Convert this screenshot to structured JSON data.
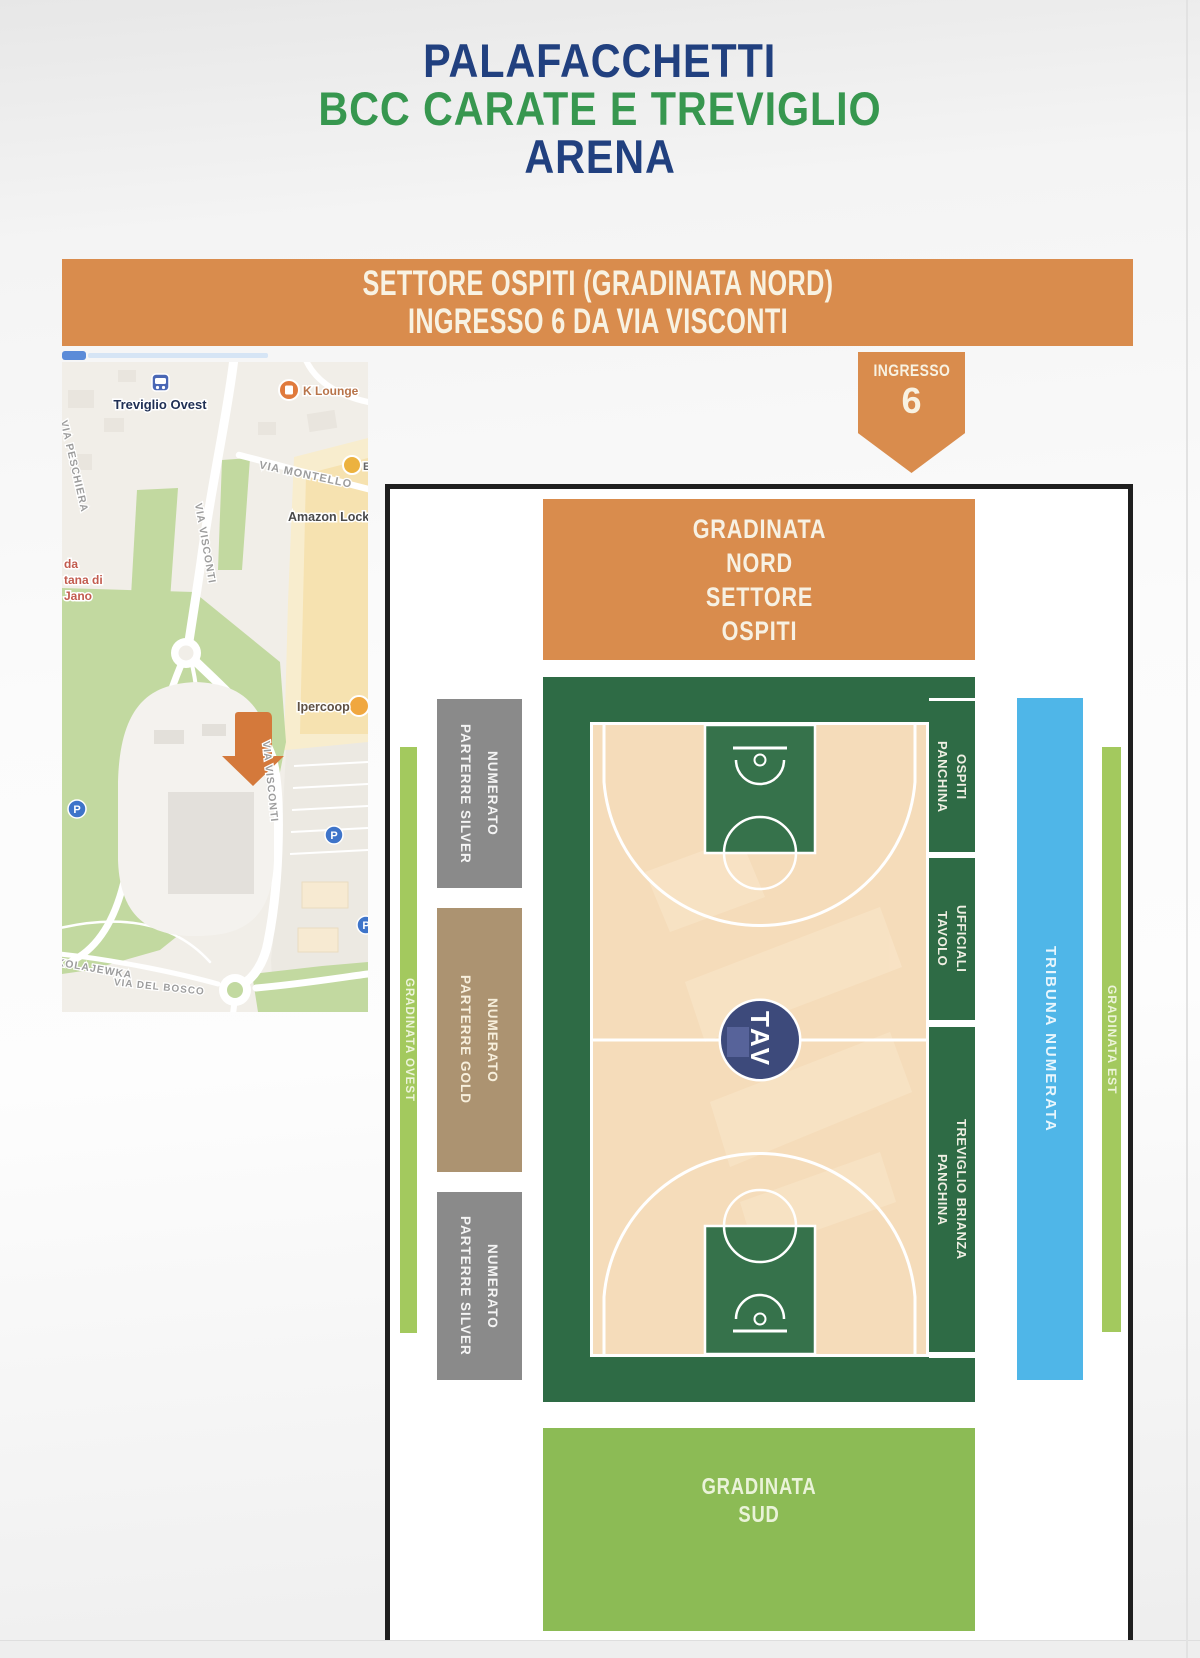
{
  "title": {
    "line1": "PALAFACCHETTI",
    "line2": "BCC CARATE E TREVIGLIO",
    "line3": "ARENA",
    "color_primary": "#21407f",
    "color_secondary": "#37974f"
  },
  "banner": {
    "line1": "SETTORE OSPITI (GRADINATA NORD)",
    "line2": "INGRESSO 6 DA VIA VISCONTI"
  },
  "entrance_badge": {
    "label": "INGRESSO",
    "number": "6"
  },
  "map": {
    "station_label": "Treviglio Ovest",
    "poi_klounge": "K Lounge",
    "poi_cut": "Ec",
    "poi_amazon": "Amazon Locker",
    "poi_ipercoop": "Ipercoop",
    "street_montello": "VIA MONTELLO",
    "street_visconti_1": "VIA VISCONTI",
    "street_visconti_2": "VIA VISCONTI",
    "street_peschiera": "VIA PESCHIERA",
    "street_kolajewka": "KOLAJEWKA",
    "street_delbosco": "VIA DEL BOSCO",
    "place_red_line1": "da",
    "place_red_line2": "tana di",
    "place_red_line3": "Jano",
    "parking_letter": "P"
  },
  "arena": {
    "nord": {
      "line1": "GRADINATA",
      "line2": "NORD",
      "line3": "SETTORE",
      "line4": "OSPITI"
    },
    "sud": {
      "line1": "GRADINATA",
      "line2": "SUD"
    },
    "ovest": "GRADINATA OVEST",
    "est": "GRADINATA EST",
    "tribuna": "TRIBUNA NUMERATA",
    "silver_top": {
      "line1": "PARTERRE SILVER",
      "line2": "NUMERATO"
    },
    "gold": {
      "line1": "PARTERRE GOLD",
      "line2": "NUMERATO"
    },
    "silver_bottom": {
      "line1": "PARTERRE SILVER",
      "line2": "NUMERATO"
    },
    "panchina_ospiti": {
      "line1": "PANCHINA",
      "line2": "OSPITI"
    },
    "tavolo": {
      "line1": "TAVOLO",
      "line2": "UFFICIALI"
    },
    "panchina_treviglio": {
      "line1": "PANCHINA",
      "line2": "TREVIGLIO BRIANZA"
    },
    "center_logo": "TAV"
  },
  "colors": {
    "orange": "#d98c4d",
    "dark_green": "#2e6b45",
    "key_green": "#36724b",
    "light_green": "#8cbb55",
    "strip_green": "#a3c95e",
    "tribuna_blue": "#4fb6e8",
    "silver_gray": "#8a8a8a",
    "gold_tan": "#ac9371",
    "floor_beige": "#f5dcba",
    "logo_navy": "#3d4a7b"
  }
}
